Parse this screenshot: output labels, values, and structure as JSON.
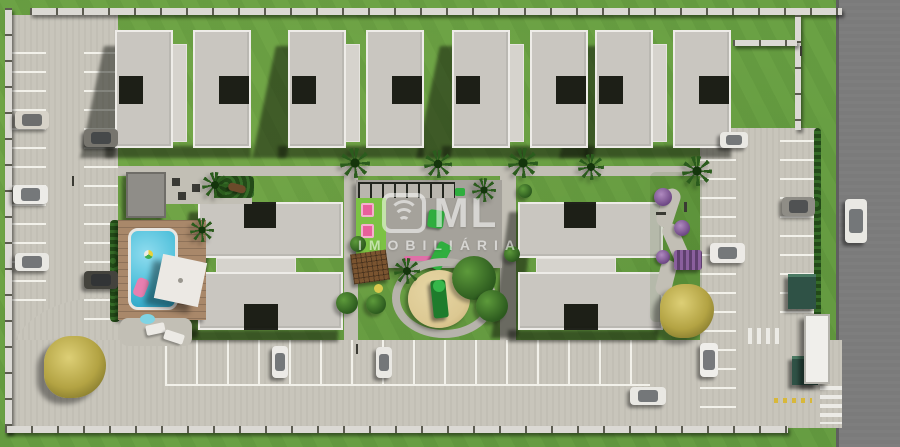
{
  "watermark": {
    "brand": "ML",
    "subtitle": "IMOBILIÁRIA"
  },
  "scene": {
    "subject": "aerial 3D render of a gated residential condominium site plan",
    "buildings": {
      "top_row_clusters": 4,
      "middle_clusters": 2,
      "apartment_blocks": 12
    },
    "amenities": [
      "swimming-pool",
      "pool-deck",
      "bbq-patio",
      "pergola-row",
      "kids-playground",
      "sandbox-slide",
      "outdoor-gym",
      "zen-garden",
      "gatehouse",
      "perimeter-wall",
      "parking-lots"
    ],
    "vehicles": {
      "parked": 11,
      "driving": 2
    },
    "colors": {
      "grass": "#6aa144",
      "internal_road": "#c8c5bb",
      "public_street": "#7b7b7b",
      "roof": "#c9c6c0",
      "roof_edge": "#eeece8",
      "pool_water": "#49bdd8",
      "pool_deck": "#a9886a",
      "sand": "#dcc892",
      "playground_pink": "#e8609a",
      "gym_green": "#2fae3e",
      "hedge": "#2c5a21",
      "watermark": "#ffffff"
    }
  }
}
